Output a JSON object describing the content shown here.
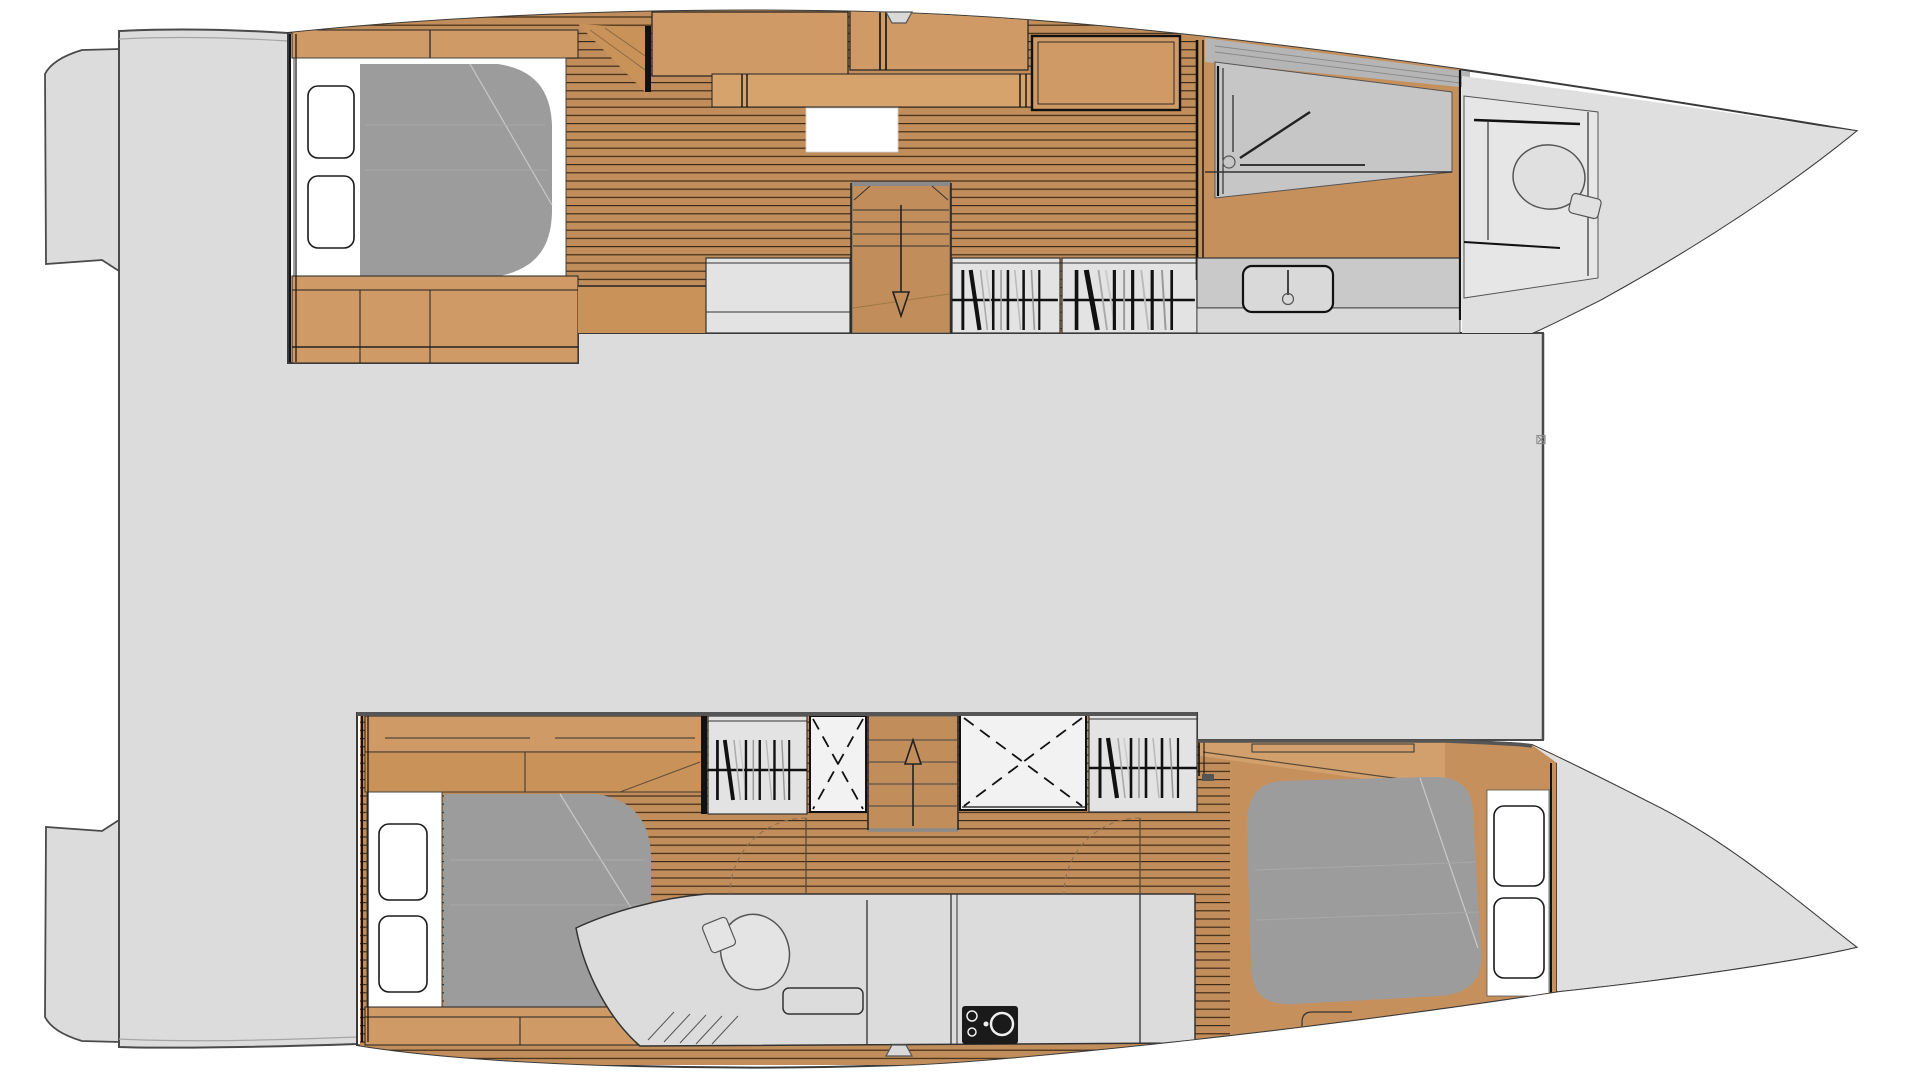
{
  "palette": {
    "page_bg": "#ffffff",
    "deck": "#dcdcdc",
    "bow_deck": "#dfdfdf",
    "deck_outline": "#4a4a4a",
    "hull_fill": "#ffffff",
    "hull_outline": "#3a3a3a",
    "plank_wood": "#c08d5b",
    "plank_line": "#241709",
    "furniture_wood": "#cf9a66",
    "furniture_wood_dark": "#c99258",
    "solid_floor_wood": "#c6905c",
    "seat_wood": "#d6a36d",
    "light_wood_wedge": "#d2a06c",
    "mattress_gray": "#9c9c9c",
    "cabin_room_gray": "#e3e3e3",
    "bathroom_gray": "#dcdcdc",
    "shower_floor": "#c6c6c6",
    "hull_side_band": "#b5b5b5",
    "counter_gray": "#c9c9c9",
    "toilet_room_gray": "#e6e6e6",
    "white_fixture": "#ffffff",
    "ink": "#111111"
  },
  "marker": {
    "glyph": "⊠"
  },
  "symbols": {
    "stairs_top_hull_arrow": "down",
    "stairs_bottom_hull_arrow": "up",
    "wardrobe_icon": "hanging-clothes",
    "crossed_locker_icon": "dashed-x",
    "bathroom_icons": [
      "toilet",
      "shower-grate"
    ],
    "galley_icons": [
      "sink-basin",
      "faucet"
    ],
    "bed_icons": [
      "mattress",
      "pillow"
    ],
    "hatch_icon": "deck-hatch-notch",
    "equipment_icon": "engine-unit"
  }
}
